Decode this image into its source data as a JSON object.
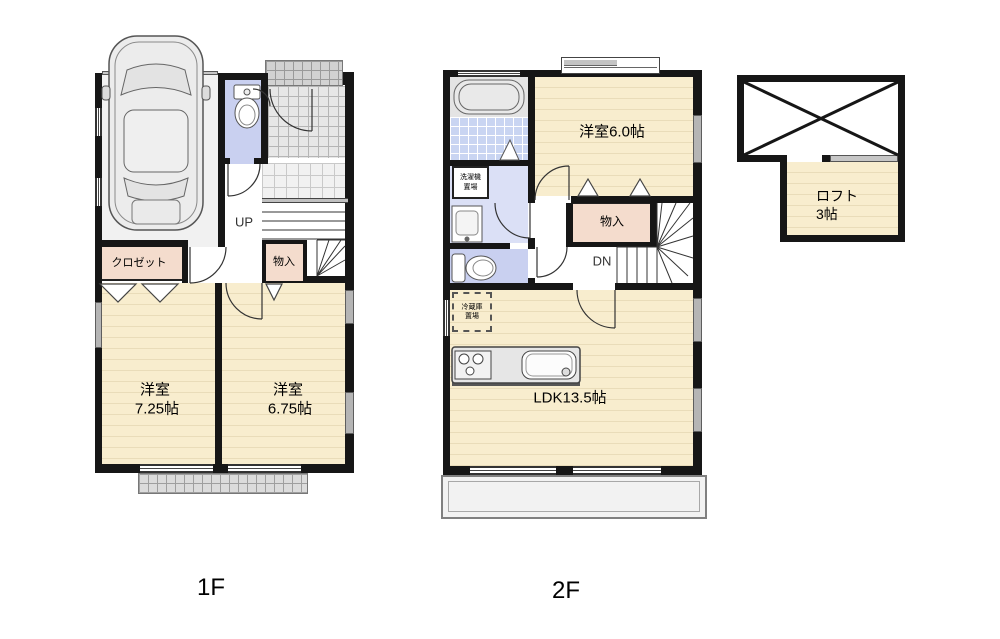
{
  "colors": {
    "wall": "#161616",
    "floor_cream": "#F8EDCE",
    "floor_stripe": "#E9DCB9",
    "closet_pink": "#F4DCCD",
    "bath_tile_blue": "#C9D5F2",
    "washroom_blue": "#DBE0F6",
    "toilet_blue": "#C9D0F0",
    "entrance_tile_gray": "#E7E7E7",
    "porch_gray": "#D2D2D2",
    "garage_gray": "#F1F1F1",
    "balcony_gray": "#F2F2F2"
  },
  "floor1": {
    "label": "1F",
    "closet": "クロゼット",
    "storage": "物入",
    "stairs": "UP",
    "bedroom1_name": "洋室",
    "bedroom1_size": "7.25帖",
    "bedroom2_name": "洋室",
    "bedroom2_size": "6.75帖"
  },
  "floor2": {
    "label": "2F",
    "bedroom": "洋室6.0帖",
    "storage": "物入",
    "stairs": "DN",
    "ldk": "LDK13.5帖",
    "washer_line1": "洗濯機",
    "washer_line2": "置場",
    "fridge_line1": "冷蔵庫",
    "fridge_line2": "置場"
  },
  "loft": {
    "name": "ロフト",
    "size": "3帖"
  }
}
